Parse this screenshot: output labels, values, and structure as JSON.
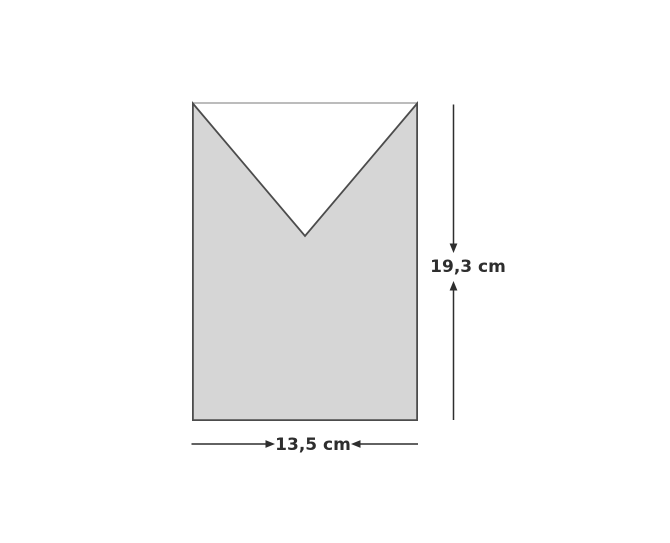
{
  "figure": {
    "dimensions": {
      "height_label": "19,3 cm",
      "width_label": "13,5 cm"
    },
    "colors": {
      "background": "#ffffff",
      "shape_fill": "#d6d6d6",
      "shape_outline": "#4c4c4c",
      "rect_top_edge": "#a6a6a6",
      "dimension_line": "#2e2e2e",
      "label_text": "#2e2e2e"
    }
  }
}
